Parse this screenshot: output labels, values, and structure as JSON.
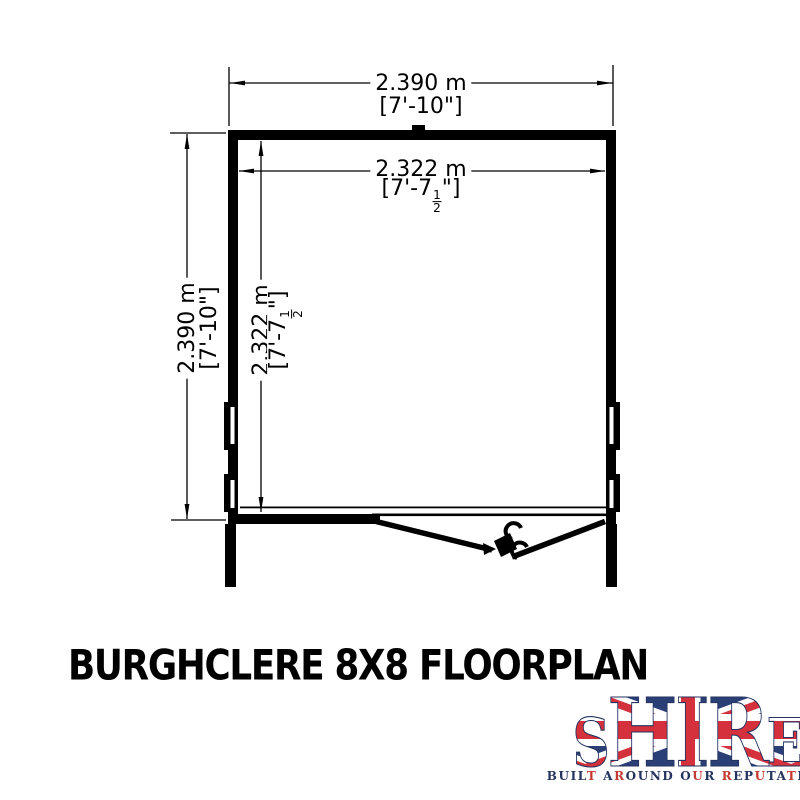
{
  "title": {
    "text": "BURGHCLERE 8X8 FLOORPLAN"
  },
  "floorplan": {
    "line_color": "#000000",
    "dims": {
      "width_outer": {
        "metric": "2.390 m",
        "imperial": "[7'-10\"]"
      },
      "width_inner": {
        "metric": "2.322 m",
        "imp_prefix": "[7'-7",
        "frac_num": "1",
        "frac_den": "2",
        "imp_suffix": "\"]"
      },
      "height_outer": {
        "metric": "2.390 m",
        "imperial": "[7'-10\"]"
      },
      "height_inner": {
        "metric": "2.322 m",
        "imp_prefix": "[7'-7",
        "frac_num": "1",
        "frac_den": "2",
        "imp_suffix": "\"]"
      }
    }
  },
  "logo": {
    "word": "SHIRE",
    "letters": [
      "S",
      "H",
      "I",
      "R",
      "E"
    ],
    "tagline": "BUILT AROUND OUR REPUTATION",
    "tagline_pattern": "nnnnr nrnnnn nrn rnnrnnrnnn",
    "navy": "#24335f",
    "red": "#c23a31"
  }
}
